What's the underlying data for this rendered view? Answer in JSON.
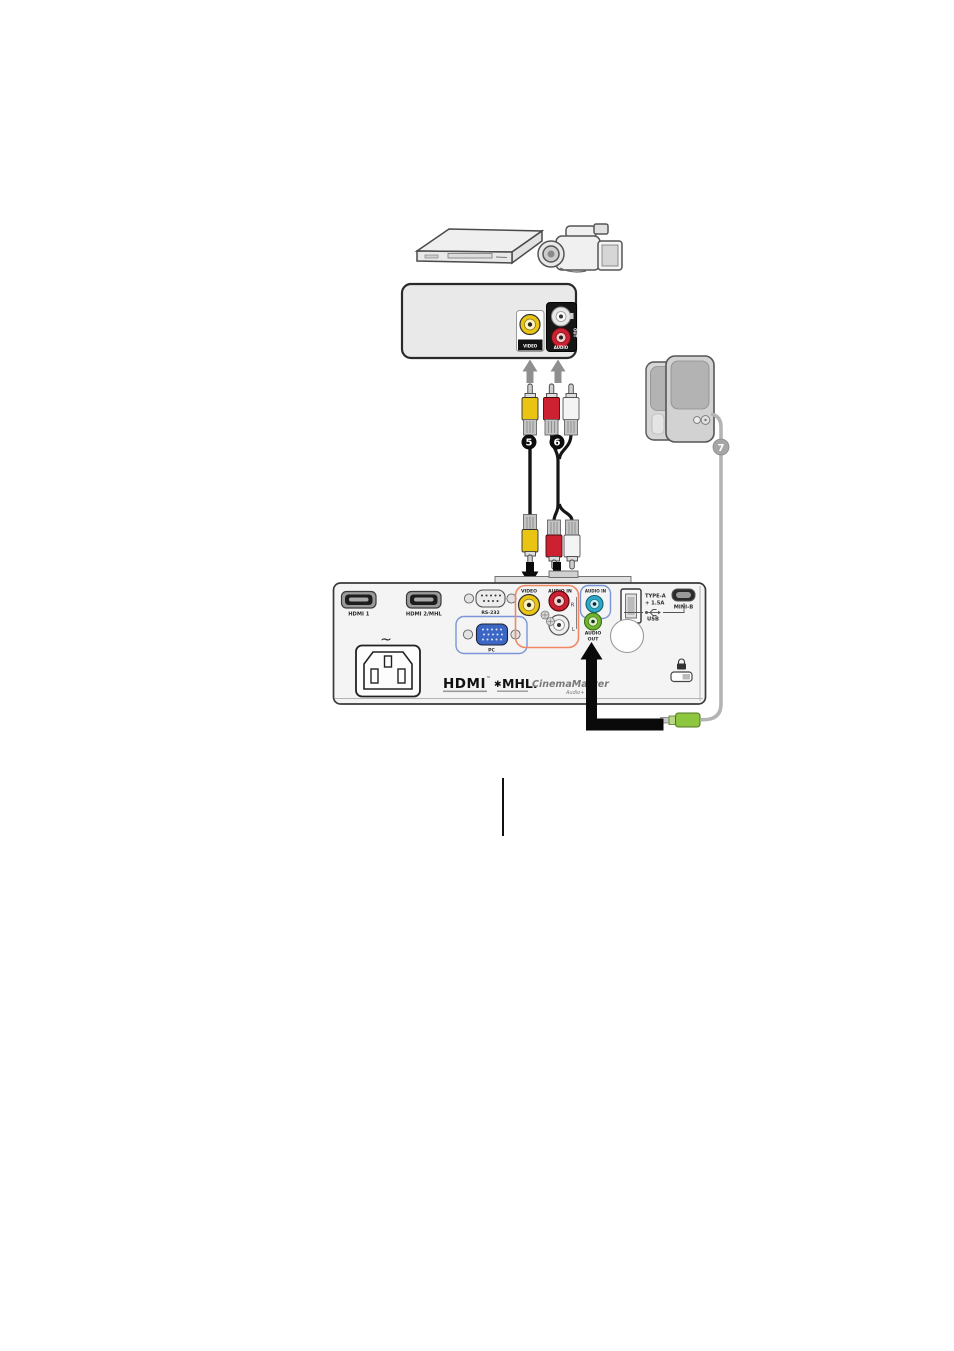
{
  "badges": {
    "composite_video": "5",
    "audio_lr": "6",
    "speaker_audio": "7"
  },
  "av_source": {
    "video_port_label": "VIDEO",
    "audio_port_label": "AUDIO",
    "audio_side_label": "OUT"
  },
  "projector": {
    "hdmi1_label": "HDMI 1",
    "hdmi2_label": "HDMI 2/MHL",
    "rs232_label": "RS-232",
    "pc_label": "PC",
    "power_symbol": "~",
    "video_label": "VIDEO",
    "audio_in_rca_label": "AUDIO IN",
    "audio_right_label": "R",
    "audio_left_label": "L",
    "audio_in_minijack_label": "AUDIO IN",
    "audio_out_label_line1": "AUDIO",
    "audio_out_label_line2": "OUT",
    "usb_type_a_label_line1": "TYPE-A",
    "usb_type_a_label_line2": "+ 1.5A",
    "usb_mini_b_label": "MINI-B",
    "usb_label": "USB",
    "logo_hdmi": "HDMI",
    "logo_hdmi_tm": "™",
    "logo_mhl_star": "✱",
    "logo_mhl": "MHL.",
    "logo_cinemamaster": "CinemaMaster",
    "logo_audio_plus": "Audio+"
  },
  "colors": {
    "rca_yellow": "#e9c412",
    "rca_red": "#cd2030",
    "rca_white": "#f4f4f4",
    "minijack_blue": "#2ea7c9",
    "minijack_green": "#6fb52f",
    "group_outline_orange": "#f08866",
    "group_outline_blue": "#7b96d8",
    "vga_blue": "#3b66c4",
    "plug_green": "#8dc63f"
  }
}
